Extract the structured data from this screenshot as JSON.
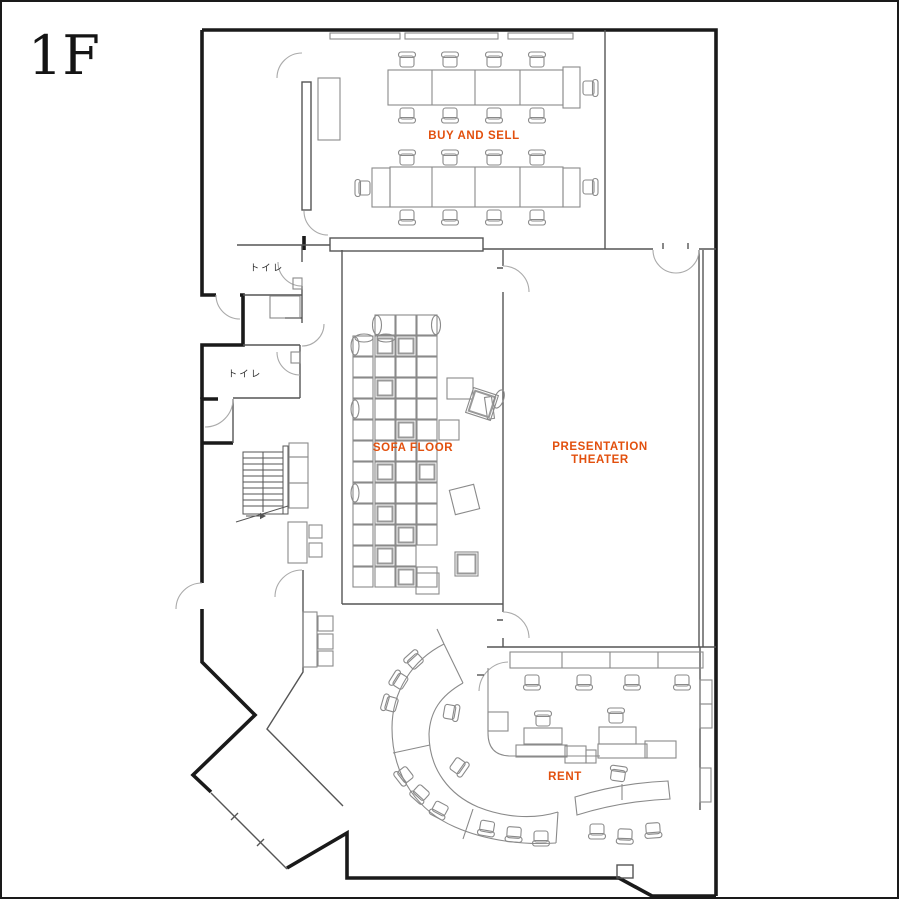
{
  "floor_label": "1F",
  "labels": {
    "buy_and_sell": "BUY AND SELL",
    "sofa_floor": "SOFA FLOOR",
    "presentation_line1": "PRESENTATION",
    "presentation_line2": "THEATER",
    "rent": "RENT",
    "toilet_upper": "トイレ",
    "toilet_lower": "トイレ"
  },
  "colors": {
    "accent": "#e2500e",
    "wall": "#1a1a1a",
    "thin": "#555555",
    "furniture": "#8a8a8a",
    "door": "#aaaaaa"
  },
  "furniture": {
    "chairs": [
      [
        407,
        61,
        0
      ],
      [
        450,
        61,
        0
      ],
      [
        494,
        61,
        0
      ],
      [
        537,
        61,
        0
      ],
      [
        407,
        114,
        180
      ],
      [
        450,
        114,
        180
      ],
      [
        494,
        114,
        180
      ],
      [
        537,
        114,
        180
      ],
      [
        589,
        88,
        90
      ],
      [
        407,
        159,
        0
      ],
      [
        450,
        159,
        0
      ],
      [
        494,
        159,
        0
      ],
      [
        537,
        159,
        0
      ],
      [
        407,
        216,
        180
      ],
      [
        450,
        216,
        180
      ],
      [
        494,
        216,
        180
      ],
      [
        537,
        216,
        180
      ],
      [
        364,
        188,
        270
      ],
      [
        589,
        187,
        90
      ],
      [
        532,
        681,
        180
      ],
      [
        584,
        681,
        180
      ],
      [
        632,
        681,
        180
      ],
      [
        682,
        681,
        180
      ],
      [
        543,
        720,
        0
      ],
      [
        616,
        717,
        0
      ],
      [
        618,
        775,
        8
      ],
      [
        597,
        830,
        180
      ],
      [
        625,
        835,
        182
      ],
      [
        653,
        829,
        176
      ],
      [
        487,
        827,
        190
      ],
      [
        514,
        833,
        184
      ],
      [
        541,
        837,
        180
      ],
      [
        405,
        775,
        232
      ],
      [
        421,
        793,
        222
      ],
      [
        440,
        809,
        208
      ],
      [
        415,
        661,
        318
      ],
      [
        400,
        681,
        302
      ],
      [
        391,
        704,
        286
      ],
      [
        450,
        712,
        100
      ],
      [
        458,
        766,
        125
      ]
    ],
    "sofa_squares": [
      [
        375,
        315,
        20,
        20,
        0,
        0
      ],
      [
        396,
        315,
        20,
        20,
        0,
        0
      ],
      [
        417,
        315,
        20,
        20,
        0,
        0
      ],
      [
        353,
        336,
        20,
        20,
        0,
        0
      ],
      [
        375,
        336,
        20,
        20,
        0,
        1
      ],
      [
        396,
        336,
        20,
        20,
        0,
        1
      ],
      [
        417,
        336,
        20,
        20,
        0,
        0
      ],
      [
        353,
        357,
        20,
        20,
        0,
        0
      ],
      [
        375,
        357,
        20,
        20,
        0,
        0
      ],
      [
        396,
        357,
        20,
        20,
        0,
        0
      ],
      [
        417,
        357,
        20,
        20,
        0,
        0
      ],
      [
        353,
        378,
        20,
        20,
        0,
        0
      ],
      [
        375,
        378,
        20,
        20,
        0,
        1
      ],
      [
        396,
        378,
        20,
        20,
        0,
        0
      ],
      [
        417,
        378,
        20,
        20,
        0,
        0
      ],
      [
        353,
        399,
        20,
        20,
        0,
        0
      ],
      [
        375,
        399,
        20,
        20,
        0,
        0
      ],
      [
        396,
        399,
        20,
        20,
        0,
        0
      ],
      [
        417,
        399,
        20,
        20,
        0,
        0
      ],
      [
        353,
        420,
        20,
        20,
        0,
        0
      ],
      [
        375,
        420,
        20,
        20,
        0,
        0
      ],
      [
        396,
        420,
        20,
        20,
        0,
        1
      ],
      [
        417,
        420,
        20,
        20,
        0,
        0
      ],
      [
        439,
        420,
        20,
        20,
        0,
        0
      ],
      [
        353,
        441,
        20,
        20,
        0,
        0
      ],
      [
        375,
        441,
        20,
        20,
        0,
        0
      ],
      [
        396,
        441,
        20,
        20,
        0,
        0
      ],
      [
        417,
        441,
        20,
        20,
        0,
        0
      ],
      [
        353,
        462,
        20,
        20,
        0,
        0
      ],
      [
        375,
        462,
        20,
        20,
        0,
        1
      ],
      [
        396,
        462,
        20,
        20,
        0,
        0
      ],
      [
        417,
        462,
        20,
        20,
        0,
        1
      ],
      [
        353,
        483,
        20,
        20,
        0,
        0
      ],
      [
        375,
        483,
        20,
        20,
        0,
        0
      ],
      [
        396,
        483,
        20,
        20,
        0,
        0
      ],
      [
        417,
        483,
        20,
        20,
        0,
        0
      ],
      [
        353,
        504,
        20,
        20,
        0,
        0
      ],
      [
        375,
        504,
        20,
        20,
        0,
        1
      ],
      [
        396,
        504,
        20,
        20,
        0,
        0
      ],
      [
        417,
        504,
        20,
        20,
        0,
        0
      ],
      [
        353,
        525,
        20,
        20,
        0,
        0
      ],
      [
        375,
        525,
        20,
        20,
        0,
        0
      ],
      [
        396,
        525,
        20,
        20,
        0,
        1
      ],
      [
        417,
        525,
        20,
        20,
        0,
        0
      ],
      [
        353,
        546,
        20,
        20,
        0,
        0
      ],
      [
        375,
        546,
        20,
        20,
        0,
        1
      ],
      [
        396,
        546,
        20,
        20,
        0,
        0
      ],
      [
        353,
        567,
        20,
        20,
        0,
        0
      ],
      [
        375,
        567,
        20,
        20,
        0,
        0
      ],
      [
        396,
        567,
        20,
        20,
        0,
        1
      ],
      [
        417,
        567,
        20,
        20,
        0,
        0
      ],
      [
        447,
        378,
        26,
        21,
        0,
        0
      ],
      [
        469,
        391,
        26,
        26,
        18,
        1
      ],
      [
        452,
        487,
        25,
        25,
        -14,
        0
      ],
      [
        455,
        552,
        23,
        24,
        0,
        1
      ],
      [
        416,
        573,
        23,
        21,
        0,
        0
      ]
    ],
    "pillows": [
      [
        377,
        325,
        4.5,
        9.5,
        0
      ],
      [
        436,
        325,
        4.5,
        9.5,
        0
      ],
      [
        355,
        346,
        4,
        9,
        0
      ],
      [
        355,
        409,
        4,
        9,
        0
      ],
      [
        355,
        493,
        4,
        9,
        0
      ],
      [
        364,
        338,
        9,
        4,
        0
      ],
      [
        386,
        338,
        9,
        4,
        0
      ],
      [
        499,
        399,
        4.5,
        9.5,
        20
      ]
    ]
  }
}
